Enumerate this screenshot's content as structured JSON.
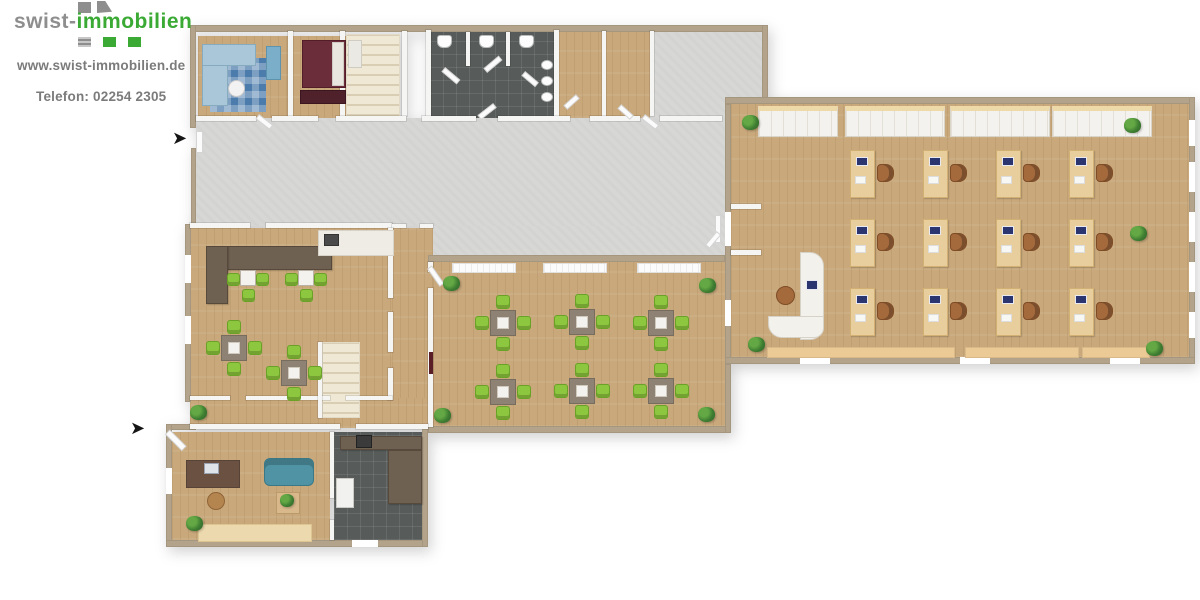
{
  "branding": {
    "logo_prefix": "swist-",
    "logo_suffix": "immobilien",
    "website": "www.swist-immobilien.de",
    "phone": "Telefon: 02254 2305"
  },
  "colors": {
    "brand_green": "#3aaa35",
    "brand_gray": "#8e8e8e",
    "text_gray": "#7b7b7b",
    "wall_tan": "#b2a38a",
    "wall_white": "#f5f5f3",
    "wood": "#c9a97c",
    "wood_light": "#e8cd9d",
    "floor_gray": "#d7d7d5",
    "tile_dark": "#575c5a",
    "stairs_cream": "#efe8d5",
    "chair_green": "#8dc63f",
    "table_gray": "#8e8275",
    "chair_brown": "#a56a3c",
    "monitor_blue": "#2b3570",
    "sofa_teal": "#4f93a4",
    "sofa_blue": "#a9c7d8",
    "rug_blue": "#4b7cab",
    "bed_maroon": "#6b2d39",
    "counter_brown": "#6f6152",
    "plant_green": "#3e7d32",
    "shelf_top_tan": "#eed9a8",
    "radiator_tan": "#ecca96"
  },
  "floorplan": {
    "entrance_arrow": "➤",
    "office": {
      "desks": {
        "rows": 3,
        "cols": 4,
        "x0": 850,
        "y0": 150,
        "dx": 73,
        "dy": 69,
        "w": 23,
        "h": 46
      },
      "shelves": [
        [
          758,
          78
        ],
        [
          845,
          98
        ],
        [
          950,
          98
        ],
        [
          1052,
          98
        ]
      ],
      "shelf_y": 106,
      "radiators": [
        [
          767,
          186
        ],
        [
          965,
          112
        ],
        [
          1082,
          66
        ]
      ],
      "radiator_y": 347,
      "plants": [
        [
          742,
          115
        ],
        [
          1124,
          118
        ],
        [
          1130,
          226
        ],
        [
          748,
          337
        ],
        [
          1146,
          341
        ]
      ]
    },
    "seminar": {
      "tables": [
        [
          502,
          322
        ],
        [
          581,
          321
        ],
        [
          660,
          322
        ],
        [
          502,
          391
        ],
        [
          581,
          390
        ],
        [
          660,
          390
        ]
      ],
      "blinds": [
        [
          452,
          62
        ],
        [
          543,
          62
        ],
        [
          637,
          62
        ]
      ],
      "blind_y": 263,
      "plants": [
        [
          443,
          276
        ],
        [
          699,
          278
        ],
        [
          434,
          408
        ],
        [
          698,
          407
        ]
      ]
    },
    "bistro": {
      "tables": [
        [
          233,
          347
        ],
        [
          293,
          372
        ]
      ],
      "small_tables": [
        [
          247,
          277
        ],
        [
          305,
          277
        ]
      ],
      "plants": [
        [
          190,
          405
        ]
      ]
    },
    "wc": {
      "toilet_xs": [
        437,
        479,
        519
      ],
      "toilet_y": 35,
      "urinal_ys": [
        60,
        76,
        92
      ],
      "urinal_x": 541
    },
    "bottom_office": {
      "plants": [
        [
          186,
          516
        ]
      ]
    }
  }
}
